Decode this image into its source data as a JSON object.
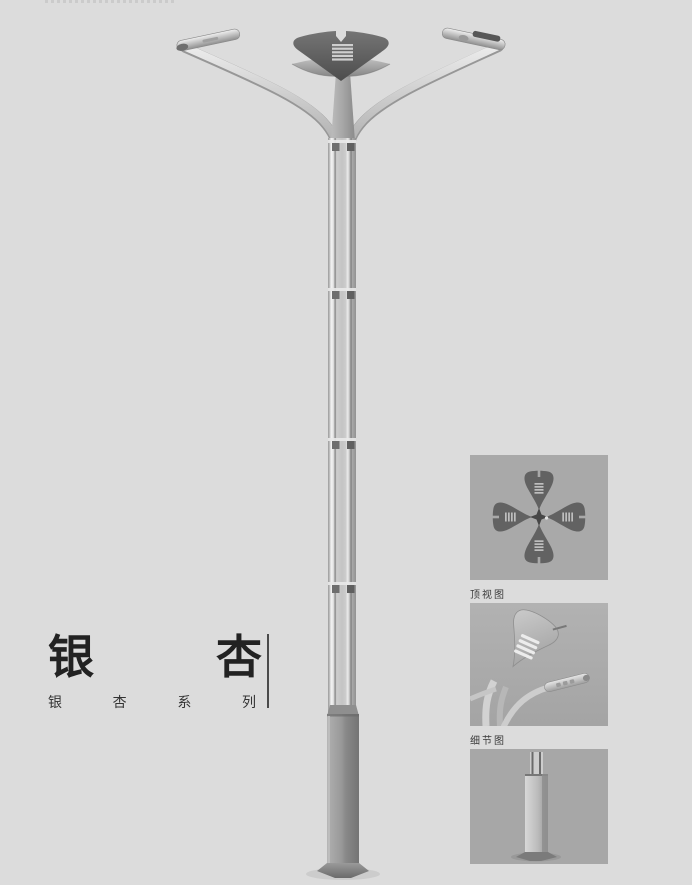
{
  "page": {
    "background_color": "#dcdcdc",
    "product_title": "银杏",
    "product_series": "银杏系列"
  },
  "title_block": {
    "title_chars": [
      "银",
      "杏"
    ],
    "subtitle_chars": [
      "银",
      "杏",
      "系",
      "列"
    ]
  },
  "detail_panels": [
    {
      "label": "顶视图"
    },
    {
      "label": "细节图"
    },
    {
      "label": ""
    }
  ],
  "colors": {
    "page_bg": "#dcdcdc",
    "panel_bg": "#a9a9a9",
    "title_text": "#222222",
    "label_text": "#3a3a3a",
    "lamp_leaf_dark": "#5a5a5a",
    "lamp_metal_light": "#d8d8d8",
    "lamp_metal_mid": "#9a9a9a"
  }
}
